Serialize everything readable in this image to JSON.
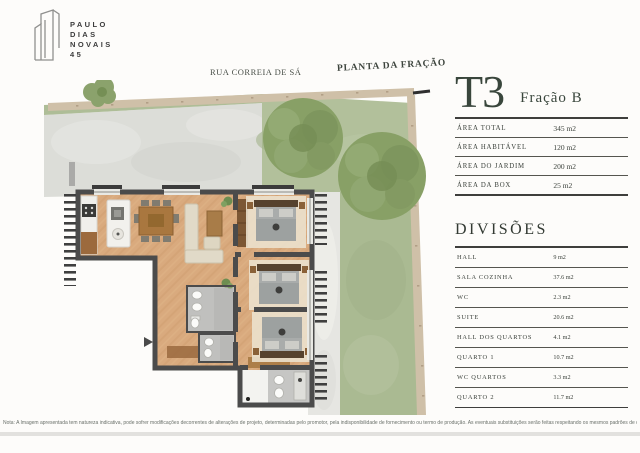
{
  "brand": {
    "name": "PAULO DIAS NOVAIS 45",
    "name_lines": [
      "PAULO",
      "DIAS",
      "NOVAIS",
      "45"
    ]
  },
  "plan": {
    "street_label": "RUA CORREIA DE SÁ",
    "title": "PLANTA DA FRAÇÃO"
  },
  "unit": {
    "type": "T3",
    "fraction": "Fração B",
    "areas": [
      {
        "label": "ÁREA TOTAL",
        "value": "345 m2"
      },
      {
        "label": "ÁREA HABITÁVEL",
        "value": "120 m2"
      },
      {
        "label": "ÁREA DO JARDIM",
        "value": "200 m2"
      },
      {
        "label": "ÁREA DA BOX",
        "value": "25 m2"
      }
    ],
    "divisions_title": "DIVISÕES",
    "divisions": [
      {
        "label": "HALL",
        "value": "9 m2"
      },
      {
        "label": "SALA COZINHA",
        "value": "37.6 m2"
      },
      {
        "label": "WC",
        "value": "2.3 m2"
      },
      {
        "label": "SUITE",
        "value": "20.6 m2"
      },
      {
        "label": "HALL DOS QUARTOS",
        "value": "4.1 m2"
      },
      {
        "label": "QUARTO 1",
        "value": "10.7 m2"
      },
      {
        "label": "WC QUARTOS",
        "value": "3.3 m2"
      },
      {
        "label": "QUARTO 2",
        "value": "11.7 m2"
      }
    ]
  },
  "footer": {
    "note": "Nota: A Imagem apresentada tem natureza indicativa, pode sofrer modificações decorrentes de alterações de projeto, determinadas pelo promotor, pela indisponibilidade de fornecimento ou termo de produção. As eventuais substituições serão feitas respeitando os mesmos padrões de qualidade"
  },
  "colors": {
    "accent_green": "#39463c",
    "stone_wall": "#cfc0a8",
    "grass": "#b2c09b",
    "concrete_patio": "#dcddd8",
    "wood_floor": "#d9aa7e",
    "interior_wall": "#4b4b4b",
    "path": "#e6e6e2"
  }
}
